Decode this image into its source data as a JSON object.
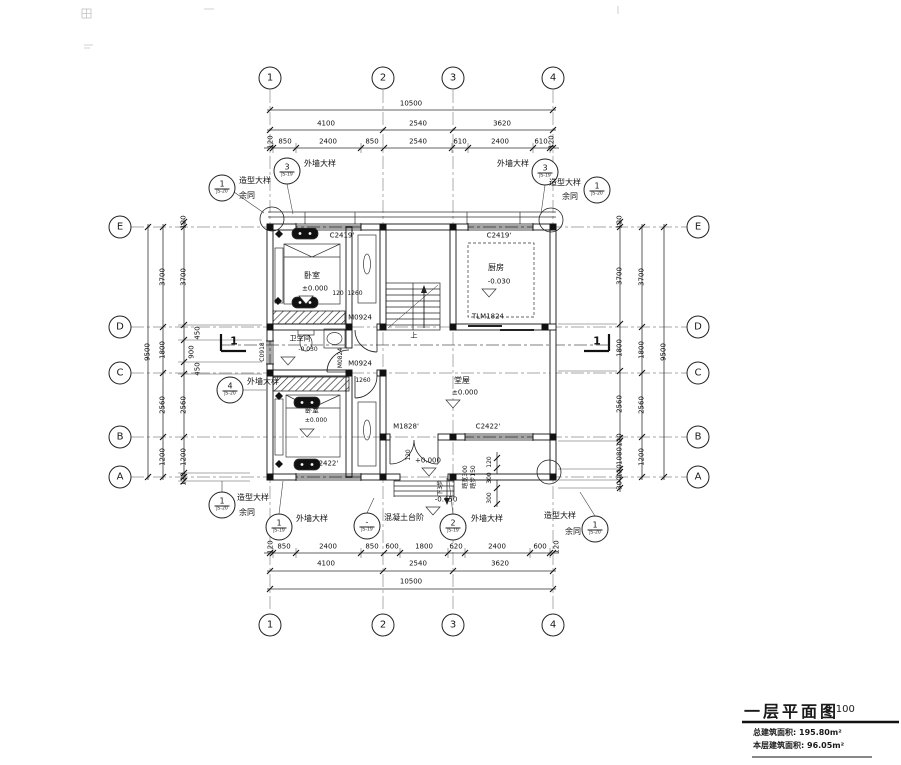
{
  "title_block": {
    "title": "一层平面图",
    "scale": "1:100",
    "total_area_label": "总建筑面积:",
    "total_area": "195.80m²",
    "floor_area_label": "本层建筑面积:",
    "floor_area": "96.05m²"
  },
  "axes": {
    "top": [
      "1",
      "2",
      "3",
      "4"
    ],
    "bottom": [
      "1",
      "2",
      "3",
      "4"
    ],
    "left": [
      "E",
      "D",
      "C",
      "B",
      "A"
    ],
    "right": [
      "E",
      "D",
      "C",
      "B",
      "A"
    ]
  },
  "dims": {
    "top": {
      "overall": "10500",
      "mid": [
        "4100",
        "2540",
        "3620"
      ],
      "inner": [
        "120",
        "850",
        "2400",
        "850",
        "2540",
        "610",
        "2400",
        "610",
        "120"
      ]
    },
    "bottom": {
      "overall": "10500",
      "mid": [
        "4100",
        "2540",
        "3620"
      ],
      "inner": [
        "120",
        "850",
        "2400",
        "850",
        "600",
        "1800",
        "620",
        "2400",
        "600",
        "120"
      ]
    },
    "left": {
      "overall": "9500",
      "mid": [
        "3700",
        "1800",
        "2560",
        "1200"
      ],
      "inner": [
        "120",
        "3700",
        "450",
        "900",
        "450",
        "2560",
        "1200",
        "120"
      ]
    },
    "right": {
      "overall": "9500",
      "mid": [
        "3700",
        "1800",
        "2560",
        "1200"
      ],
      "inner": [
        "120",
        "3700",
        "1800",
        "2560",
        "120",
        "1080",
        "120",
        "300"
      ]
    }
  },
  "rooms": {
    "bedroom1": {
      "name": "卧室",
      "level": "±0.000"
    },
    "bedroom2": {
      "name": "卧室",
      "level": "±0.000"
    },
    "kitchen": {
      "name": "厨房",
      "level": "-0.030"
    },
    "bathroom": {
      "name": "卫生间",
      "level": "-0.030"
    },
    "hall": {
      "name": "堂屋",
      "level": "±0.000"
    },
    "vestibule": {
      "level": "+0.000"
    },
    "outdoor": {
      "level": "-0.450"
    }
  },
  "openings": {
    "c2419_left": "C2419'",
    "c2419_right": "C2419'",
    "c0918": "C0918",
    "c2422_b": "C2422'",
    "c2422_hall": "C2422'",
    "tlm1824": "TLM1824",
    "m0924_a": "M0924",
    "m0924_b": "M0924",
    "m0824": "M0824",
    "m1828": "M1828'"
  },
  "plan_dims": {
    "d120_corr": "120",
    "d1260_corr": "1260",
    "d1260_door": "1260",
    "d120_entry": "120",
    "d120_r": "120",
    "d300_r1": "300",
    "d300_r2": "300"
  },
  "stair": {
    "up": "上",
    "down": "下3步",
    "tread": "踏宽300",
    "riser": "踏步150"
  },
  "callouts": {
    "tl_outer": {
      "num": "1",
      "ref": "JS-20",
      "label": "造型大样",
      "label2": "余同"
    },
    "tl_inner": {
      "num": "3",
      "ref": "JS-19",
      "label": "外墙大样"
    },
    "tr_inner": {
      "num": "3",
      "ref": "JS-19",
      "label": "外墙大样"
    },
    "tr_outer": {
      "num": "1",
      "ref": "JS-20",
      "label": "造型大样",
      "label2": "余同"
    },
    "left_mid": {
      "num": "4",
      "ref": "JS-20",
      "label": "外墙大样"
    },
    "b1": {
      "num": "1",
      "ref": "JS-19",
      "label": "外墙大样"
    },
    "b2": {
      "num": "-",
      "ref": "JS-19",
      "label": "混凝土台阶"
    },
    "b3": {
      "num": "2",
      "ref": "JS-19",
      "label": "外墙大样"
    },
    "bl_outer": {
      "num": "1",
      "ref": "JS-20",
      "label": "造型大样",
      "label2": "余同"
    },
    "br_outer": {
      "num": "1",
      "ref": "JS-20",
      "label": "造型大样",
      "label2": "余同"
    }
  },
  "section": {
    "mark": "1"
  }
}
